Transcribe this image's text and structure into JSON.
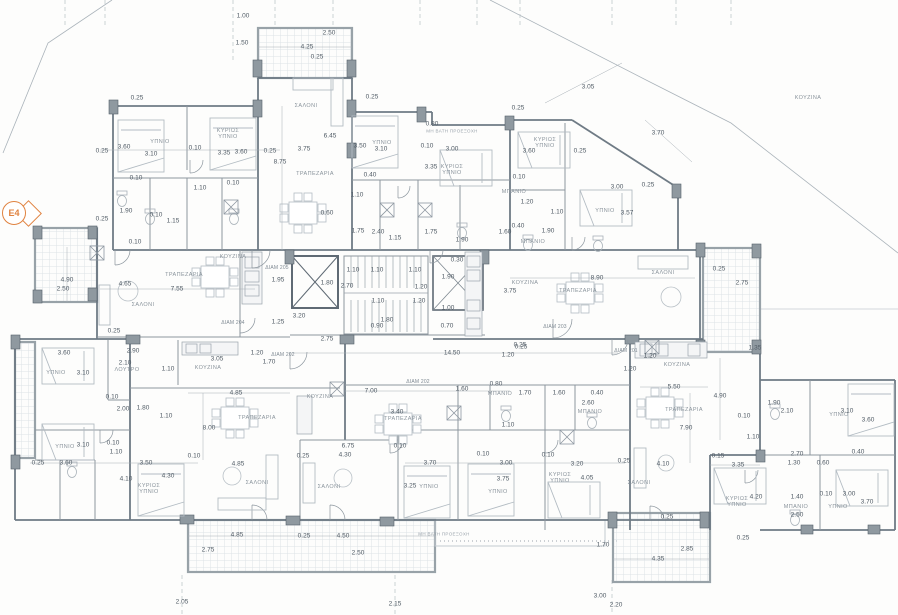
{
  "drawing": {
    "section_marker": {
      "label": "E4",
      "color": "#e0823f"
    },
    "colors": {
      "wall": "#6f7b85",
      "interior": "#8d969e",
      "furniture": "#b3bcc3",
      "dim_text": "#4f5a64",
      "room_text": "#8a949c",
      "marker": "#e0823f"
    },
    "labels": {
      "rooms": [
        {
          "t": "ΣΑΛΟΝΙ",
          "x": 306,
          "y": 106
        },
        {
          "t": "ΤΡΑΠΕΖΑΡΙΑ",
          "x": 315,
          "y": 174
        },
        {
          "t": "ΥΠΝΙΟ",
          "x": 160,
          "y": 142
        },
        {
          "t": "ΚΥΡΙΩΣ\nΥΠΝΙΟ",
          "x": 228,
          "y": 134
        },
        {
          "t": "ΥΠΝΙΟ",
          "x": 382,
          "y": 143
        },
        {
          "t": "ΚΥΡΙΩΣ\nΥΠΝΙΟ",
          "x": 452,
          "y": 170
        },
        {
          "t": "ΚΥΡΙΩΣ\nΥΠΝΙΟ",
          "x": 545,
          "y": 143
        },
        {
          "t": "ΥΠΝΙΟ",
          "x": 605,
          "y": 211
        },
        {
          "t": "ΜΠΑΝΙΟ",
          "x": 514,
          "y": 192
        },
        {
          "t": "ΜΠΑΝΙΟ",
          "x": 533,
          "y": 242
        },
        {
          "t": "ΚΟΥΖΙΝΑ",
          "x": 233,
          "y": 257
        },
        {
          "t": "ΤΡΑΠΕΖΑΡΙΑ",
          "x": 184,
          "y": 275
        },
        {
          "t": "ΣΑΛΟΝΙ",
          "x": 143,
          "y": 305
        },
        {
          "t": "ΚΟΥΖΙΝΑ",
          "x": 525,
          "y": 283
        },
        {
          "t": "ΤΡΑΠΕΖΑΡΙΑ",
          "x": 578,
          "y": 291
        },
        {
          "t": "ΣΑΛΟΝΙ",
          "x": 663,
          "y": 273
        },
        {
          "t": "ΚΟΥΖΙΝΑ",
          "x": 808,
          "y": 98
        },
        {
          "t": "ΥΠΝΙΟ",
          "x": 56,
          "y": 373
        },
        {
          "t": "ΛΟΥΤΡΟ",
          "x": 127,
          "y": 370
        },
        {
          "t": "ΚΟΥΖΙΝΑ",
          "x": 208,
          "y": 368
        },
        {
          "t": "ΥΠΝΙΟ",
          "x": 65,
          "y": 447
        },
        {
          "t": "ΚΥΡΙΩΣ\nΥΠΝΙΟ",
          "x": 149,
          "y": 489
        },
        {
          "t": "ΤΡΑΠΕΖΑΡΙΑ",
          "x": 257,
          "y": 418
        },
        {
          "t": "ΣΑΛΟΝΙ",
          "x": 257,
          "y": 483
        },
        {
          "t": "ΚΟΥΖΙΝΑ",
          "x": 320,
          "y": 397
        },
        {
          "t": "ΣΑΛΟΝΙ",
          "x": 329,
          "y": 487
        },
        {
          "t": "ΤΡΑΠΕΖΑΡΙΑ",
          "x": 403,
          "y": 419
        },
        {
          "t": "ΥΠΝΙΟ",
          "x": 429,
          "y": 487
        },
        {
          "t": "ΜΠΑΝΙΟ",
          "x": 500,
          "y": 394
        },
        {
          "t": "ΜΠΑΝΙΟ",
          "x": 590,
          "y": 412
        },
        {
          "t": "ΥΠΝΙΟ",
          "x": 498,
          "y": 492
        },
        {
          "t": "ΚΥΡΙΩΣ\nΥΠΝΙΟ",
          "x": 560,
          "y": 478
        },
        {
          "t": "ΚΟΥΖΙΝΑ",
          "x": 677,
          "y": 365
        },
        {
          "t": "ΤΡΑΠΕΖΑΡΙΑ",
          "x": 684,
          "y": 410
        },
        {
          "t": "ΣΑΛΟΝΙ",
          "x": 639,
          "y": 483
        },
        {
          "t": "ΥΠΝΙΟ",
          "x": 839,
          "y": 415
        },
        {
          "t": "ΚΥΡΙΩΣ\nΥΠΝΙΟ",
          "x": 737,
          "y": 502
        },
        {
          "t": "ΜΠΑΝΙΟ",
          "x": 796,
          "y": 507
        },
        {
          "t": "ΥΠΝΙΟ",
          "x": 838,
          "y": 507
        }
      ],
      "apartments": [
        {
          "t": "ΔΙΑΜ 205",
          "x": 277,
          "y": 269
        },
        {
          "t": "ΔΙΑΜ 204",
          "x": 233,
          "y": 324
        },
        {
          "t": "ΔΙΑΜ 202",
          "x": 283,
          "y": 356
        },
        {
          "t": "ΔΙΑΜ 203",
          "x": 555,
          "y": 328
        },
        {
          "t": "ΔΙΑΜ 202",
          "x": 418,
          "y": 383
        },
        {
          "t": "ΔΙΑΜ 201",
          "x": 626,
          "y": 352
        }
      ],
      "notes": [
        {
          "t": "ΜΗ ΒΑΤΗ ΠΡΟΕΞΟΧΗ",
          "x": 452,
          "y": 131
        },
        {
          "t": "ΜΗ ΒΑΤΗ ΠΡΟΕΞΟΧΗ",
          "x": 444,
          "y": 534
        }
      ],
      "dimensions": [
        {
          "t": "1.00",
          "x": 243,
          "y": 16
        },
        {
          "t": "1.50",
          "x": 242,
          "y": 43
        },
        {
          "t": "2.50",
          "x": 329,
          "y": 33
        },
        {
          "t": "4.25",
          "x": 307,
          "y": 47
        },
        {
          "t": "0.25",
          "x": 317,
          "y": 57
        },
        {
          "t": "0.25",
          "x": 137,
          "y": 98
        },
        {
          "t": "0.25",
          "x": 372,
          "y": 97
        },
        {
          "t": "0.25",
          "x": 518,
          "y": 108
        },
        {
          "t": "3.05",
          "x": 588,
          "y": 87
        },
        {
          "t": "3.70",
          "x": 658,
          "y": 133
        },
        {
          "t": "0.80",
          "x": 432,
          "y": 124
        },
        {
          "t": "6.45",
          "x": 330,
          "y": 136
        },
        {
          "t": "3.75",
          "x": 304,
          "y": 149
        },
        {
          "t": "0.25",
          "x": 270,
          "y": 151
        },
        {
          "t": "8.75",
          "x": 280,
          "y": 162
        },
        {
          "t": "0.25",
          "x": 102,
          "y": 151
        },
        {
          "t": "3.60",
          "x": 124,
          "y": 147
        },
        {
          "t": "3.10",
          "x": 151,
          "y": 154
        },
        {
          "t": "0.10",
          "x": 195,
          "y": 148
        },
        {
          "t": "3.35",
          "x": 224,
          "y": 153
        },
        {
          "t": "3.60",
          "x": 241,
          "y": 152
        },
        {
          "t": "3.50",
          "x": 360,
          "y": 146
        },
        {
          "t": "3.10",
          "x": 381,
          "y": 149
        },
        {
          "t": "0.10",
          "x": 427,
          "y": 146
        },
        {
          "t": "3.00",
          "x": 452,
          "y": 149
        },
        {
          "t": "3.35",
          "x": 431,
          "y": 167
        },
        {
          "t": "0.40",
          "x": 370,
          "y": 175
        },
        {
          "t": "3.60",
          "x": 529,
          "y": 151
        },
        {
          "t": "0.25",
          "x": 580,
          "y": 151
        },
        {
          "t": "0.10",
          "x": 519,
          "y": 177
        },
        {
          "t": "3.00",
          "x": 617,
          "y": 187
        },
        {
          "t": "0.25",
          "x": 648,
          "y": 185
        },
        {
          "t": "3.57",
          "x": 627,
          "y": 213
        },
        {
          "t": "0.10",
          "x": 136,
          "y": 178
        },
        {
          "t": "1.10",
          "x": 200,
          "y": 188
        },
        {
          "t": "0.10",
          "x": 233,
          "y": 183
        },
        {
          "t": "1.90",
          "x": 126,
          "y": 211
        },
        {
          "t": "0.10",
          "x": 156,
          "y": 215
        },
        {
          "t": "1.15",
          "x": 173,
          "y": 221
        },
        {
          "t": "0.25",
          "x": 102,
          "y": 219
        },
        {
          "t": "0.10",
          "x": 135,
          "y": 242
        },
        {
          "t": "1.10",
          "x": 357,
          "y": 195
        },
        {
          "t": "0.60",
          "x": 327,
          "y": 213
        },
        {
          "t": "1.75",
          "x": 358,
          "y": 231
        },
        {
          "t": "2.40",
          "x": 378,
          "y": 232
        },
        {
          "t": "1.15",
          "x": 395,
          "y": 238
        },
        {
          "t": "1.75",
          "x": 431,
          "y": 232
        },
        {
          "t": "1.90",
          "x": 462,
          "y": 240
        },
        {
          "t": "1.20",
          "x": 527,
          "y": 202
        },
        {
          "t": "1.10",
          "x": 557,
          "y": 212
        },
        {
          "t": "1.90",
          "x": 548,
          "y": 231
        },
        {
          "t": "0.40",
          "x": 518,
          "y": 226
        },
        {
          "t": "1.60",
          "x": 505,
          "y": 232
        },
        {
          "t": "0.30",
          "x": 457,
          "y": 260
        },
        {
          "t": "1.10",
          "x": 353,
          "y": 270
        },
        {
          "t": "1.10",
          "x": 377,
          "y": 270
        },
        {
          "t": "1.10",
          "x": 415,
          "y": 270
        },
        {
          "t": "1.80",
          "x": 327,
          "y": 283
        },
        {
          "t": "2.70",
          "x": 347,
          "y": 286
        },
        {
          "t": "1.90",
          "x": 448,
          "y": 277
        },
        {
          "t": "1.20",
          "x": 421,
          "y": 287
        },
        {
          "t": "1.20",
          "x": 419,
          "y": 301
        },
        {
          "t": "1.10",
          "x": 378,
          "y": 301
        },
        {
          "t": "1.00",
          "x": 448,
          "y": 308
        },
        {
          "t": "0.70",
          "x": 447,
          "y": 326
        },
        {
          "t": "1.80",
          "x": 387,
          "y": 320
        },
        {
          "t": "0.90",
          "x": 377,
          "y": 326
        },
        {
          "t": "3.20",
          "x": 299,
          "y": 316
        },
        {
          "t": "2.75",
          "x": 327,
          "y": 339
        },
        {
          "t": "14.50",
          "x": 452,
          "y": 353
        },
        {
          "t": "0.25",
          "x": 520,
          "y": 345
        },
        {
          "t": "4.90",
          "x": 67,
          "y": 280
        },
        {
          "t": "2.50",
          "x": 63,
          "y": 289
        },
        {
          "t": "4.65",
          "x": 125,
          "y": 284
        },
        {
          "t": "7.55",
          "x": 177,
          "y": 289
        },
        {
          "t": "0.25",
          "x": 114,
          "y": 331
        },
        {
          "t": "2.90",
          "x": 133,
          "y": 351
        },
        {
          "t": "1.95",
          "x": 278,
          "y": 280
        },
        {
          "t": "1.25",
          "x": 278,
          "y": 322
        },
        {
          "t": "1.20",
          "x": 257,
          "y": 353
        },
        {
          "t": "1.70",
          "x": 269,
          "y": 362
        },
        {
          "t": "8.90",
          "x": 597,
          "y": 278
        },
        {
          "t": "3.75",
          "x": 510,
          "y": 291
        },
        {
          "t": "0.25",
          "x": 719,
          "y": 269
        },
        {
          "t": "2.75",
          "x": 742,
          "y": 283
        },
        {
          "t": "1.35",
          "x": 755,
          "y": 348
        },
        {
          "t": "0.25",
          "x": 521,
          "y": 347
        },
        {
          "t": "1.20",
          "x": 508,
          "y": 355
        },
        {
          "t": "1.20",
          "x": 650,
          "y": 356
        },
        {
          "t": "3.60",
          "x": 64,
          "y": 353
        },
        {
          "t": "3.10",
          "x": 83,
          "y": 373
        },
        {
          "t": "2.10",
          "x": 125,
          "y": 363
        },
        {
          "t": "1.10",
          "x": 168,
          "y": 369
        },
        {
          "t": "3.05",
          "x": 217,
          "y": 359
        },
        {
          "t": "0.10",
          "x": 112,
          "y": 397
        },
        {
          "t": "2.00",
          "x": 123,
          "y": 409
        },
        {
          "t": "1.80",
          "x": 143,
          "y": 408
        },
        {
          "t": "1.10",
          "x": 166,
          "y": 416
        },
        {
          "t": "8.00",
          "x": 209,
          "y": 428
        },
        {
          "t": "3.10",
          "x": 83,
          "y": 445
        },
        {
          "t": "0.10",
          "x": 113,
          "y": 443
        },
        {
          "t": "1.10",
          "x": 116,
          "y": 452
        },
        {
          "t": "0.10",
          "x": 194,
          "y": 456
        },
        {
          "t": "3.50",
          "x": 146,
          "y": 463
        },
        {
          "t": "0.25",
          "x": 38,
          "y": 463
        },
        {
          "t": "3.60",
          "x": 66,
          "y": 463
        },
        {
          "t": "4.10",
          "x": 126,
          "y": 479
        },
        {
          "t": "4.30",
          "x": 168,
          "y": 476
        },
        {
          "t": "4.85",
          "x": 236,
          "y": 393
        },
        {
          "t": "7.00",
          "x": 371,
          "y": 391
        },
        {
          "t": "4.85",
          "x": 238,
          "y": 464
        },
        {
          "t": "0.25",
          "x": 303,
          "y": 456
        },
        {
          "t": "6.75",
          "x": 348,
          "y": 446
        },
        {
          "t": "4.30",
          "x": 345,
          "y": 455
        },
        {
          "t": "3.40",
          "x": 397,
          "y": 412
        },
        {
          "t": "0.10",
          "x": 400,
          "y": 446
        },
        {
          "t": "3.25",
          "x": 410,
          "y": 486
        },
        {
          "t": "1.60",
          "x": 462,
          "y": 389
        },
        {
          "t": "0.80",
          "x": 496,
          "y": 384
        },
        {
          "t": "1.70",
          "x": 525,
          "y": 393
        },
        {
          "t": "1.60",
          "x": 559,
          "y": 393
        },
        {
          "t": "0.40",
          "x": 597,
          "y": 393
        },
        {
          "t": "2.60",
          "x": 588,
          "y": 403
        },
        {
          "t": "1.10",
          "x": 508,
          "y": 425
        },
        {
          "t": "0.10",
          "x": 483,
          "y": 454
        },
        {
          "t": "0.10",
          "x": 548,
          "y": 455
        },
        {
          "t": "3.70",
          "x": 430,
          "y": 463
        },
        {
          "t": "3.00",
          "x": 506,
          "y": 463
        },
        {
          "t": "3.20",
          "x": 577,
          "y": 464
        },
        {
          "t": "3.75",
          "x": 503,
          "y": 479
        },
        {
          "t": "4.05",
          "x": 587,
          "y": 478
        },
        {
          "t": "0.25",
          "x": 624,
          "y": 461
        },
        {
          "t": "1.20",
          "x": 630,
          "y": 369
        },
        {
          "t": "5.50",
          "x": 674,
          "y": 387
        },
        {
          "t": "4.90",
          "x": 720,
          "y": 396
        },
        {
          "t": "7.90",
          "x": 686,
          "y": 428
        },
        {
          "t": "1.90",
          "x": 774,
          "y": 403
        },
        {
          "t": "2.10",
          "x": 787,
          "y": 411
        },
        {
          "t": "3.10",
          "x": 847,
          "y": 411
        },
        {
          "t": "3.60",
          "x": 868,
          "y": 420
        },
        {
          "t": "0.10",
          "x": 744,
          "y": 416
        },
        {
          "t": "1.10",
          "x": 753,
          "y": 437
        },
        {
          "t": "2.70",
          "x": 797,
          "y": 454
        },
        {
          "t": "1.30",
          "x": 794,
          "y": 463
        },
        {
          "t": "0.60",
          "x": 823,
          "y": 463
        },
        {
          "t": "0.40",
          "x": 858,
          "y": 452
        },
        {
          "t": "0.15",
          "x": 718,
          "y": 456
        },
        {
          "t": "3.35",
          "x": 738,
          "y": 465
        },
        {
          "t": "4.10",
          "x": 663,
          "y": 464
        },
        {
          "t": "4.20",
          "x": 756,
          "y": 497
        },
        {
          "t": "1.40",
          "x": 797,
          "y": 497
        },
        {
          "t": "0.10",
          "x": 826,
          "y": 494
        },
        {
          "t": "3.00",
          "x": 849,
          "y": 494
        },
        {
          "t": "3.70",
          "x": 867,
          "y": 502
        },
        {
          "t": "2.50",
          "x": 797,
          "y": 515
        },
        {
          "t": "0.25",
          "x": 743,
          "y": 538
        },
        {
          "t": "4.85",
          "x": 237,
          "y": 535
        },
        {
          "t": "0.25",
          "x": 304,
          "y": 536
        },
        {
          "t": "4.50",
          "x": 343,
          "y": 536
        },
        {
          "t": "2.75",
          "x": 208,
          "y": 550
        },
        {
          "t": "2.50",
          "x": 358,
          "y": 553
        },
        {
          "t": "2.05",
          "x": 182,
          "y": 602
        },
        {
          "t": "2.15",
          "x": 395,
          "y": 604
        },
        {
          "t": "1.70",
          "x": 603,
          "y": 545
        },
        {
          "t": "0.25",
          "x": 667,
          "y": 517
        },
        {
          "t": "2.85",
          "x": 687,
          "y": 549
        },
        {
          "t": "4.35",
          "x": 658,
          "y": 559
        },
        {
          "t": "3.00",
          "x": 600,
          "y": 596
        },
        {
          "t": "2.20",
          "x": 616,
          "y": 605
        }
      ]
    }
  }
}
